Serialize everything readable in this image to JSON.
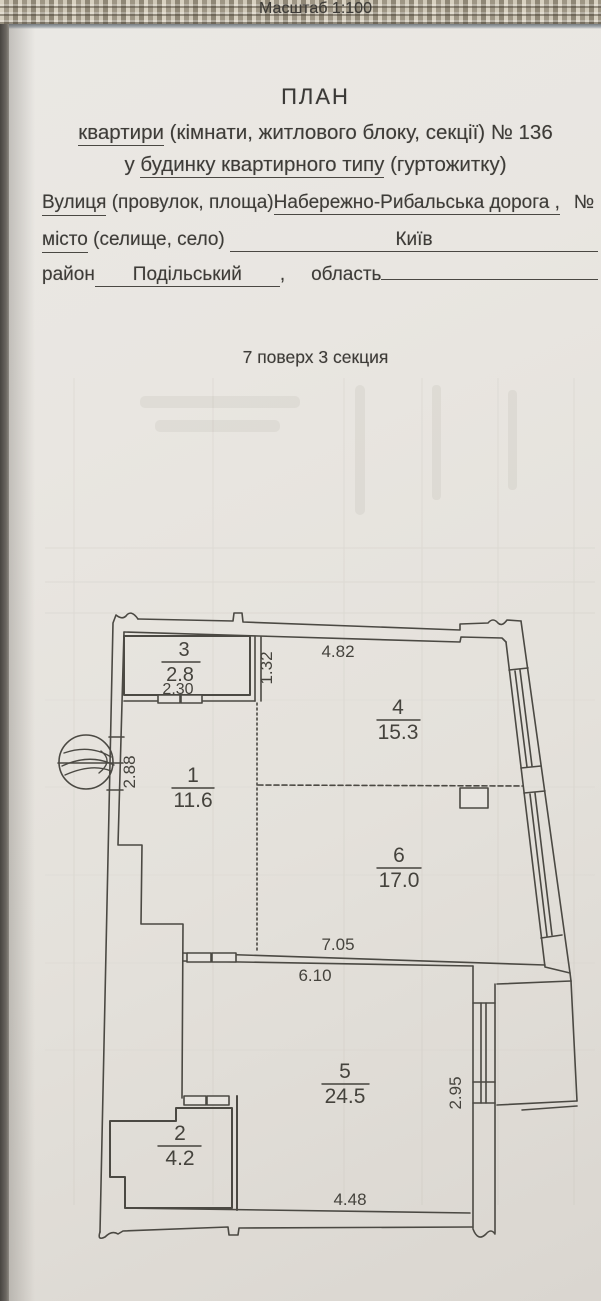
{
  "header": {
    "title": "ПЛАН",
    "line2_underlined": "квартири",
    "line2_rest": " (кімнати, житлового блоку, секції) № 136",
    "line3_prefix": "у ",
    "line3_underlined": "будинку квартирного типу",
    "line3_rest": " (гуртожитку)"
  },
  "form": {
    "street_label": "Вулиця",
    "street_label_rest": " (провулок, площа)",
    "street_value": "Набережно-Рибальська дорога ,",
    "number_sign": "№",
    "number_value": "5",
    "city_label": "місто",
    "city_label_rest": " (селище, село) ",
    "city_value": "Київ",
    "district_label": "район",
    "district_value": "Подільський",
    "comma": ",",
    "region_label": "область",
    "region_value": ""
  },
  "info": {
    "scale": "Масштаб 1:100",
    "floor_section": "7 поверх 3 секция"
  },
  "plan": {
    "ink": "#4b4943",
    "rooms": {
      "r1": {
        "num": "1",
        "area": "11.6"
      },
      "r2": {
        "num": "2",
        "area": "4.2"
      },
      "r3": {
        "num": "3",
        "area": "2.8"
      },
      "r4": {
        "num": "4",
        "area": "15.3"
      },
      "r5": {
        "num": "5",
        "area": "24.5"
      },
      "r6": {
        "num": "6",
        "area": "17.0"
      }
    },
    "dims": {
      "d230": "2.30",
      "d132": "1.32",
      "d482": "4.82",
      "d288": "2.88",
      "d705": "7.05",
      "d610": "6.10",
      "d295": "2.95",
      "d448": "4.48"
    }
  }
}
